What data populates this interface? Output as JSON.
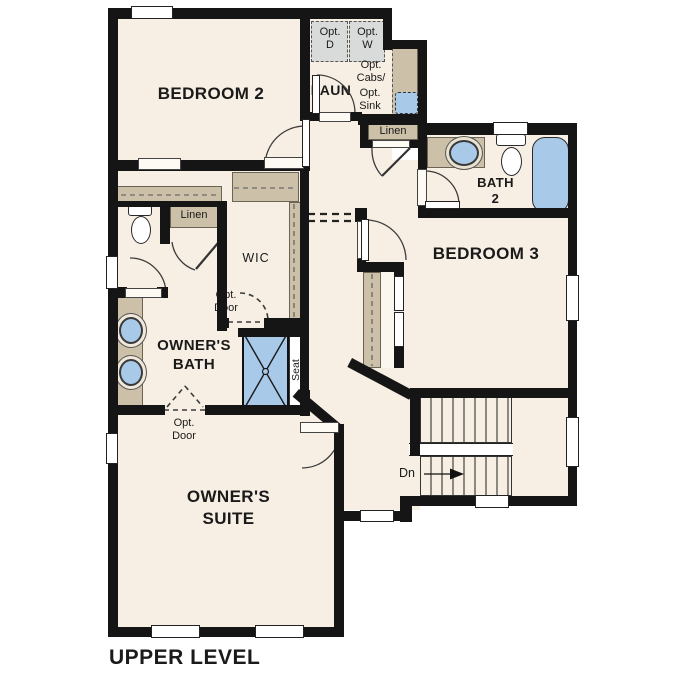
{
  "title": "UPPER LEVEL",
  "colors": {
    "wall": "#151515",
    "floor": "#f7efe3",
    "counter": "#cdc0a8",
    "fixture_blue": "#a9c9e9",
    "appliance_gray": "#d8dbda",
    "text": "#1a1a1a"
  },
  "rooms": {
    "bedroom2": "BEDROOM 2",
    "bedroom3": "BEDROOM 3",
    "owners_suite": "OWNER'S\nSUITE",
    "owners_bath": "OWNER'S\nBATH",
    "bath2": "BATH\n2",
    "laundry": "LAUN",
    "wic": "WIC",
    "linen_hall": "Linen",
    "linen_owners": "Linen"
  },
  "annotations": {
    "opt_dryer": "Opt.\nD",
    "opt_washer": "Opt.\nW",
    "opt_cabs": "Opt.\nCabs/",
    "opt_sink": "Opt.\nSink",
    "opt_door_wic": "Opt.\nDoor",
    "opt_door_suite": "Opt.\nDoor",
    "seat": "Seat",
    "down": "Dn"
  }
}
